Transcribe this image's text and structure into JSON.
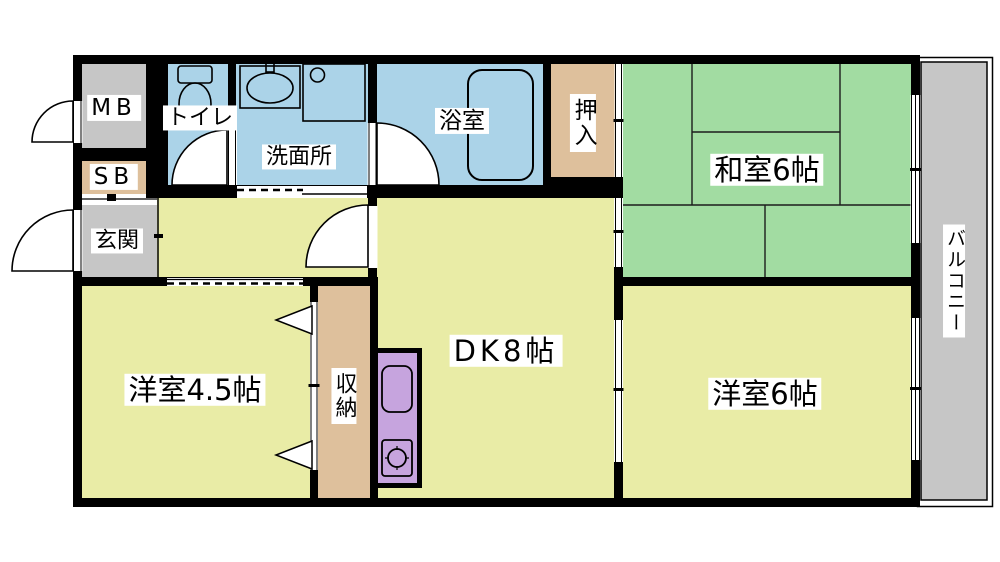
{
  "plan": {
    "type": "apartment-floor-plan",
    "rooms": {
      "mb": {
        "label": "MB"
      },
      "sb": {
        "label": "SB"
      },
      "genkan": {
        "label": "玄関"
      },
      "toilet": {
        "label": "トイレ"
      },
      "washroom": {
        "label": "洗面所"
      },
      "bathroom": {
        "label": "浴室"
      },
      "oshiire": {
        "label": "押入"
      },
      "washitsu": {
        "label": "和室6帖"
      },
      "dk": {
        "label": "DK8帖"
      },
      "western_room_45": {
        "label": "洋室4.5帖"
      },
      "storage": {
        "label": "収納"
      },
      "western_room_6": {
        "label": "洋室6帖"
      },
      "balcony": {
        "label": "バルコニー"
      }
    },
    "icons": [
      "toilet-icon",
      "washbasin-icon",
      "laundry-pan-icon",
      "bathtub-icon",
      "kitchen-sink-icon",
      "stove-icon",
      "door-swing-icon",
      "sliding-door-icon",
      "window-icon"
    ],
    "colors": {
      "wall": "#000000",
      "floor_yellow": "#e9eca6",
      "tatami_green": "#a2dca2",
      "water_blue": "#abd3e8",
      "closet_tan": "#dec09c",
      "gray": "#c6c6c6",
      "balcony_gray": "#c6c6c6",
      "kitchen_purple": "#c6a4de",
      "background": "#ffffff",
      "line": "#000000"
    }
  }
}
